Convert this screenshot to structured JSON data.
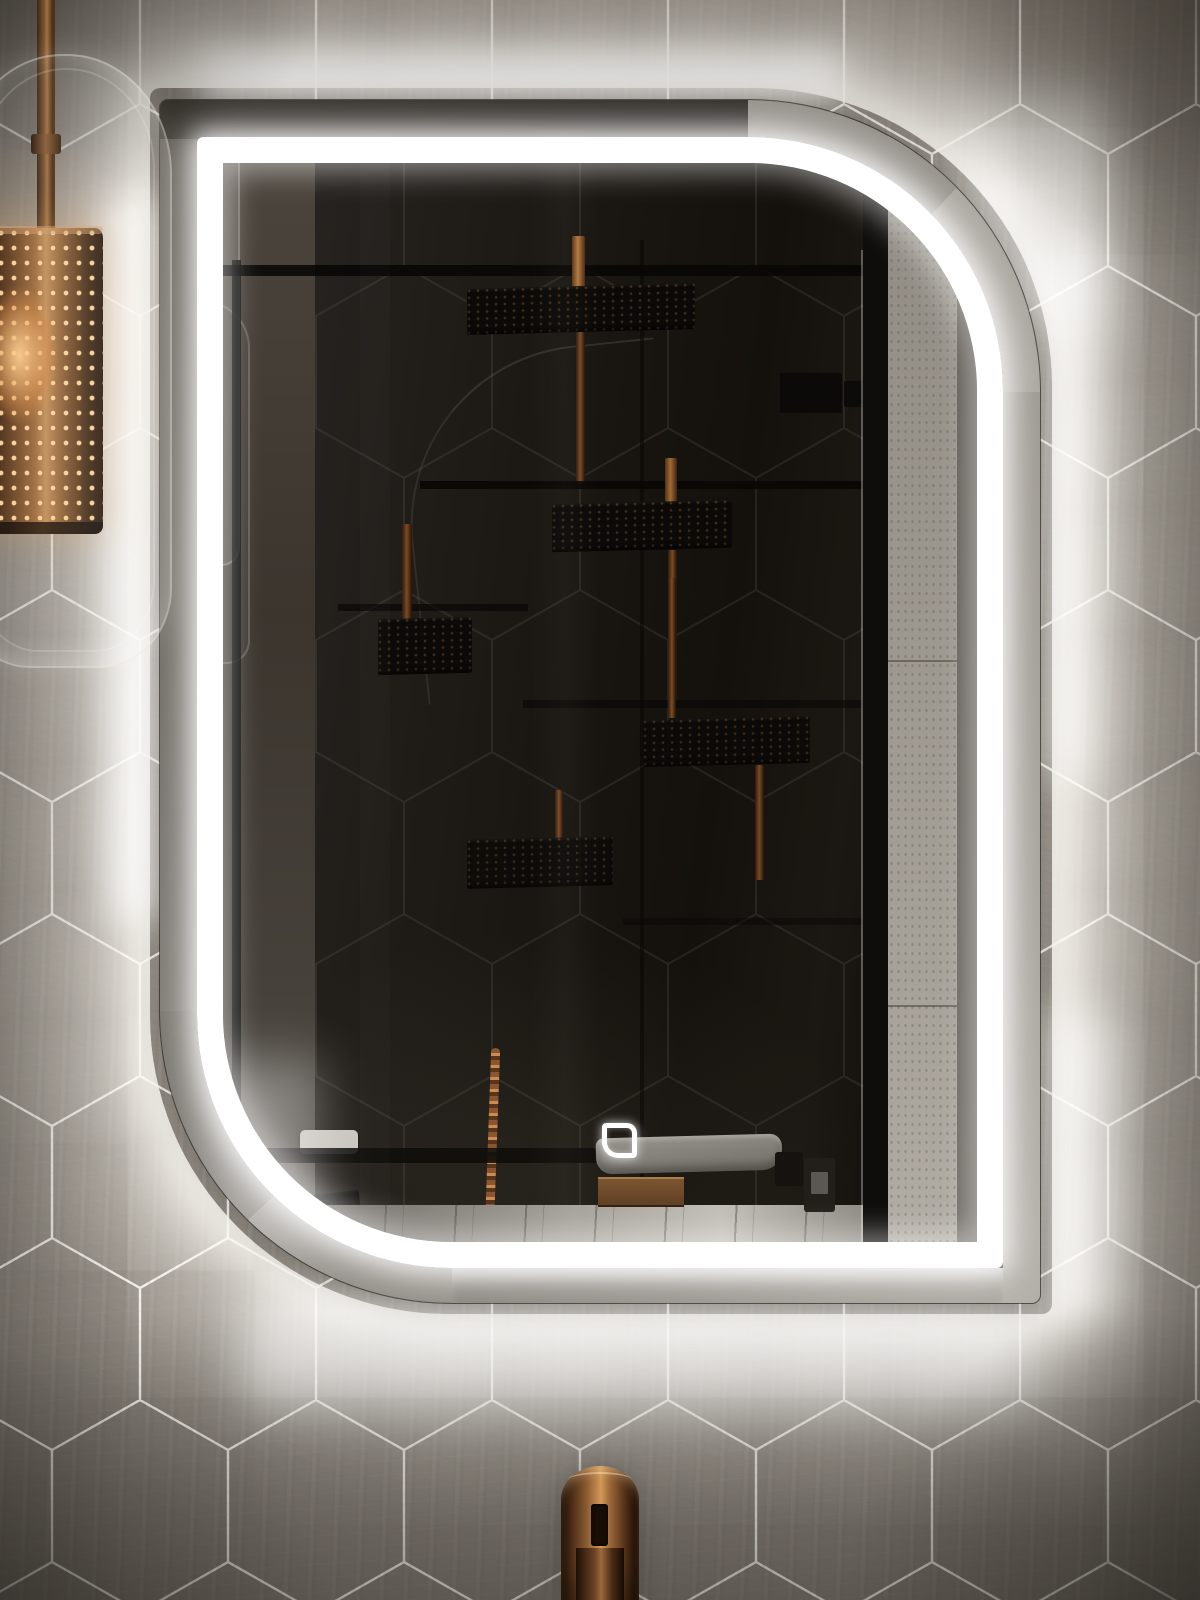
{
  "meta": {
    "scene_type": "bathroom-photograph",
    "canvas": {
      "width": 1200,
      "height": 1600
    }
  },
  "palette": {
    "wall_tile": "#979188",
    "grout": "#f2efe9",
    "glow_white": "#fffdf8",
    "mirror_glass": "#1f1b17",
    "led_white": "#ffffff",
    "frame_black": "#0e0d0b",
    "concrete_reflection": "#9b968e",
    "copper": "#8a5531",
    "copper_highlight": "#cf9255",
    "copper_deep": "#3c2412",
    "marble_counter": "#b6b2ab",
    "basin_gray": "#8d8983",
    "towel_white": "#c9c6c0"
  },
  "objects": {
    "wall": {
      "label": "Hexagonal stone tile wall with backlight glow"
    },
    "mirror": {
      "label": "Backlit LED mirror with rounded top-right and bottom-left corners"
    },
    "led_strip": {
      "label": "White LED light strip ring"
    },
    "touch_sensor": {
      "label": "Mirror touch sensor control"
    },
    "pendant": {
      "label": "Perforated copper pendant lamp in glass cylinder"
    },
    "faucet": {
      "label": "Copper faucet"
    },
    "reflection": {
      "label": "Reflected dark shower with black shower heads, copper pipes, basin and bottles"
    }
  }
}
